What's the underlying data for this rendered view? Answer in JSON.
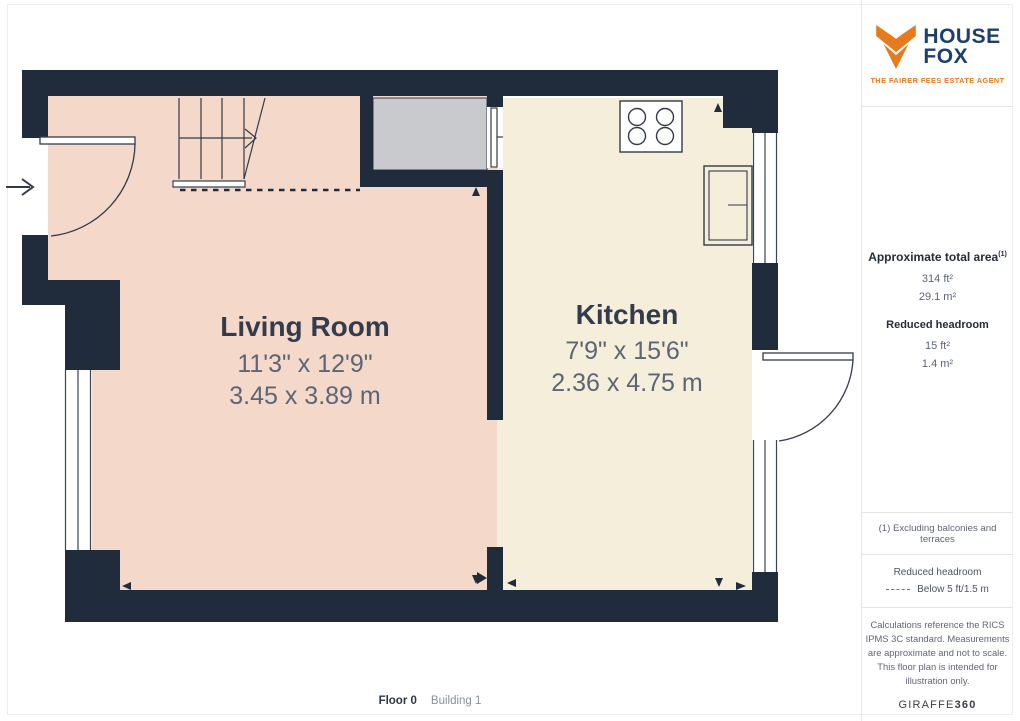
{
  "logo": {
    "brand_line1": "HOUSE",
    "brand_line2": "FOX",
    "tagline": "THE FAIRER FEES ESTATE AGENT",
    "orange": "#e87a1e",
    "navy": "#1d3f6e"
  },
  "sidebar": {
    "area": {
      "title": "Approximate total area",
      "title_sup": "(1)",
      "value_ft": "314 ft²",
      "value_m": "29.1 m²",
      "reduced_title": "Reduced headroom",
      "reduced_ft": "15 ft²",
      "reduced_m": "1.4 m²"
    },
    "footnote": "(1) Excluding balconies and terraces",
    "legend": {
      "title": "Reduced headroom",
      "value": "Below 5 ft/1.5 m"
    },
    "disclaimer": "Calculations reference the RICS IPMS 3C standard. Measurements are approximate and not to scale. This floor plan is intended for illustration only.",
    "brand": "GIRAFFE",
    "brand_bold": "360"
  },
  "floorplan": {
    "rooms": [
      {
        "name": "Living Room",
        "dims_imperial": "11'3\" x 12'9\"",
        "dims_metric": "3.45 x 3.89 m"
      },
      {
        "name": "Kitchen",
        "dims_imperial": "7'9\" x 15'6\"",
        "dims_metric": "2.36 x 4.75 m"
      }
    ],
    "colors": {
      "wall": "#202b3c",
      "living_fill": "#f4d9cb",
      "kitchen_fill": "#f4eeda",
      "landing_fill": "#c9cacd",
      "line": "#333b49",
      "title_text": "#333b4d",
      "dim_text": "#5c6575"
    }
  },
  "footer": {
    "floor_label": "Floor 0",
    "building_label": "Building 1"
  }
}
